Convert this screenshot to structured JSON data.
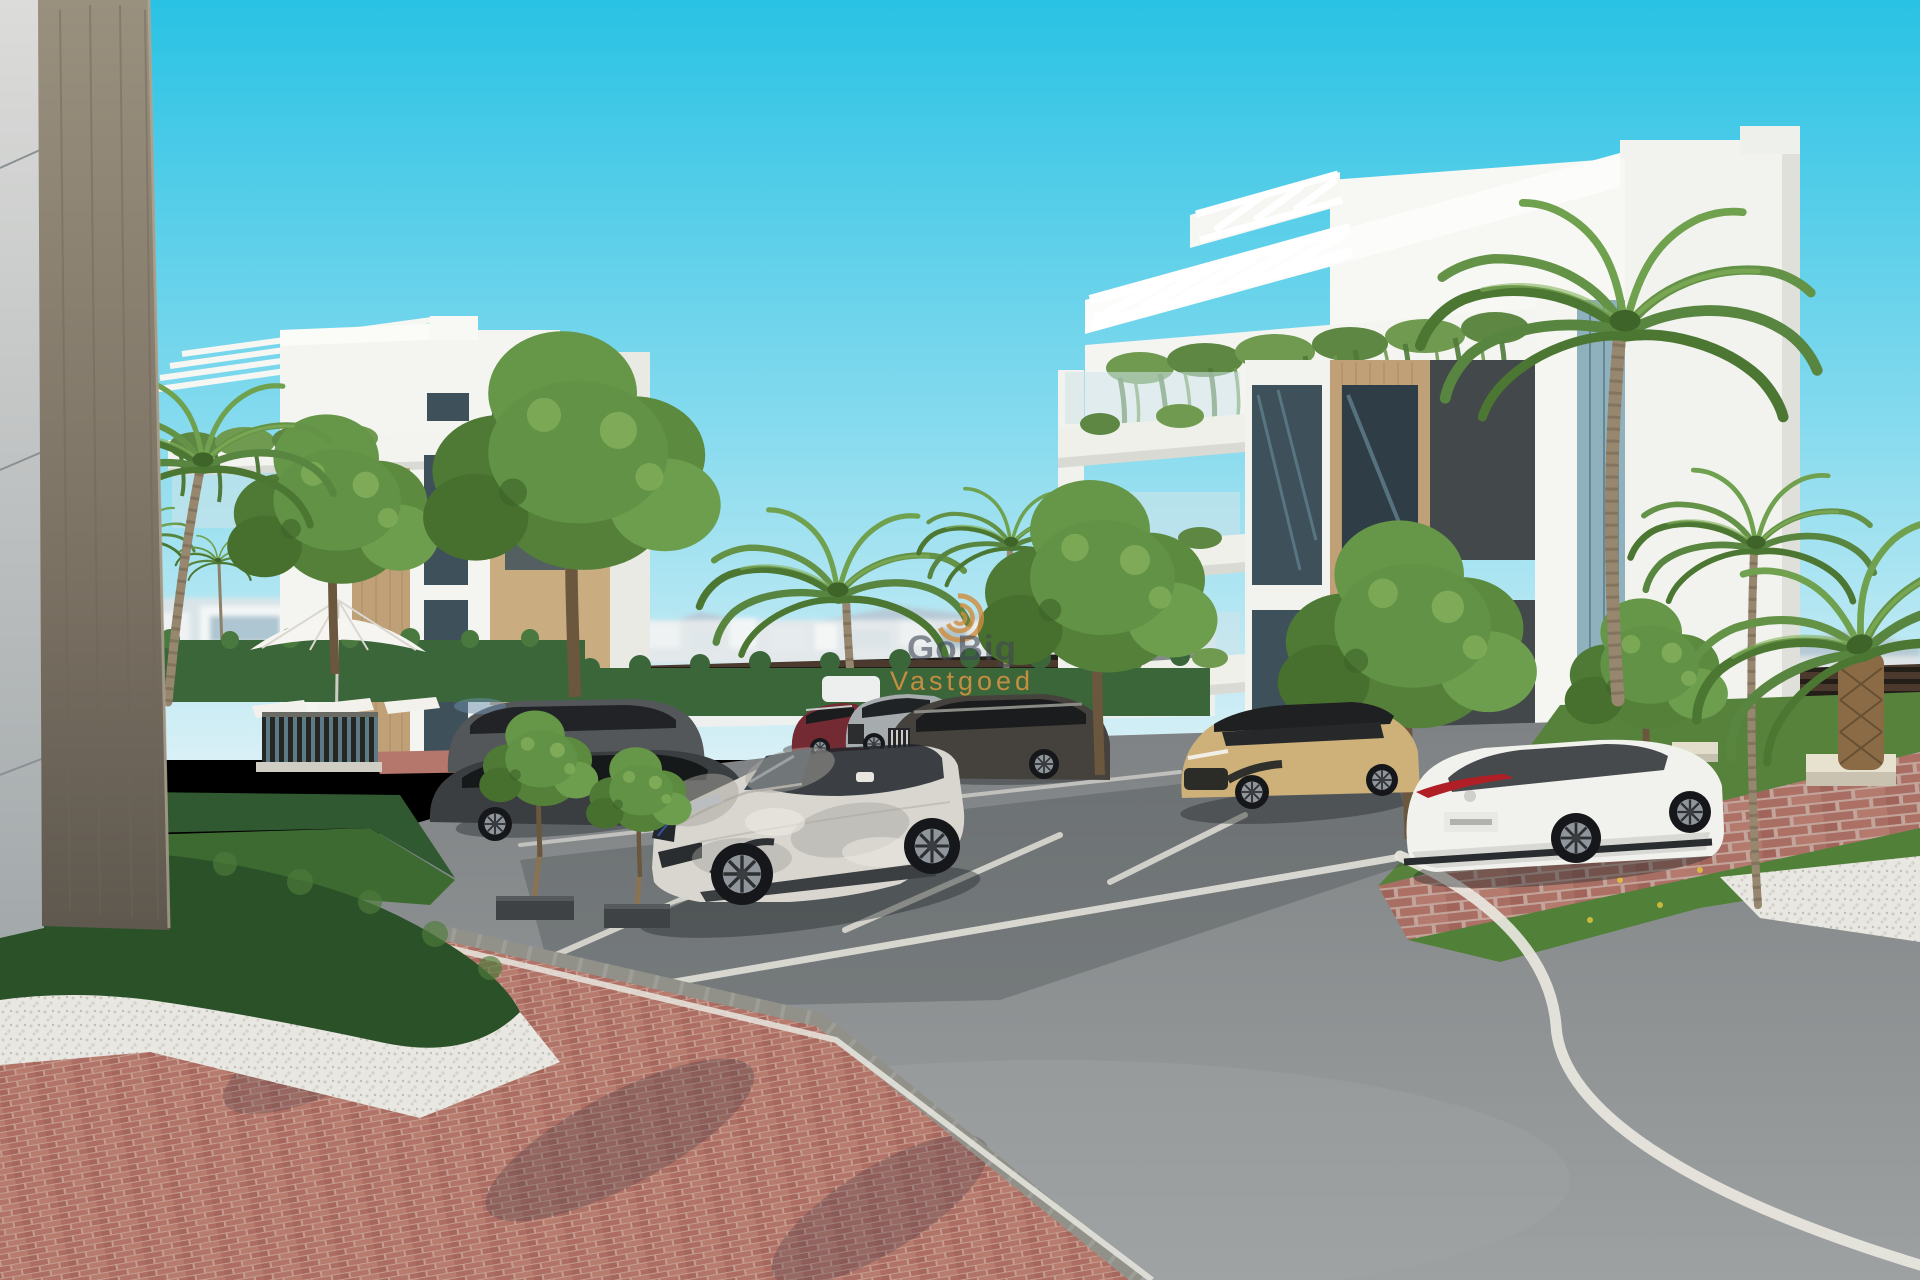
{
  "scene": {
    "type": "architectural-3d-render",
    "setting": "Modern white apartment complex with palm trees, landscaped hedges, parking bays and a curved asphalt road",
    "lighting": "bright sunny day, clear cyan sky"
  },
  "watermark": {
    "line1": "GoBig",
    "line2": "Vastgoed",
    "logo": "spiral-logo",
    "line1_color": "#3f4654",
    "line2_color": "#dd9443"
  },
  "palette": {
    "sky_top": "#29c2e4",
    "sky_horizon": "#d9f0f6",
    "building_white": "#f4f5f1",
    "building_shade": "#d9dad3",
    "wood_accent": "#bfa077",
    "anthracite_panel": "#43484b",
    "window_glass": "#3e515b",
    "hedge_dark": "#2b5129",
    "tree_green": "#619245",
    "palm_green": "#588540",
    "grass": "#57823c",
    "brick_paving": "#b0706a",
    "asphalt": "#8b8e8f",
    "curb": "#9e9e98",
    "gravel_white": "#e9e7e1",
    "road_marking": "#e9e7df"
  },
  "buildings": {
    "left": {
      "label": "white apartment block with rooftop pergola, hanging plants and wood-tone accents"
    },
    "right": {
      "label": "five-storey white apartment block with rooftop pergola, planted balconies, wood and anthracite panels"
    },
    "foreground_corner": {
      "label": "close-up building corner with grey panel cladding and travertine pillar"
    }
  },
  "vehicles": [
    {
      "name": "dark-grey-estate",
      "color": "#53575a"
    },
    {
      "name": "black-sedan",
      "color": "#3a3e41"
    },
    {
      "name": "silver-suv",
      "color": "#d8d6cf"
    },
    {
      "name": "maroon-suv",
      "color": "#742a33"
    },
    {
      "name": "grey-suv",
      "color": "#a6abad"
    },
    {
      "name": "dark-brown-suv",
      "color": "#45423d"
    },
    {
      "name": "sand-gold-suv",
      "color": "#cdb179"
    },
    {
      "name": "white-sedan",
      "color": "#f1f1ee"
    }
  ],
  "landscape": [
    "palm trees",
    "young deciduous trees",
    "clipped box hedges",
    "lawn",
    "white parasol with sun loungers",
    "pool fence",
    "stone benches",
    "brick paving",
    "white gravel"
  ]
}
